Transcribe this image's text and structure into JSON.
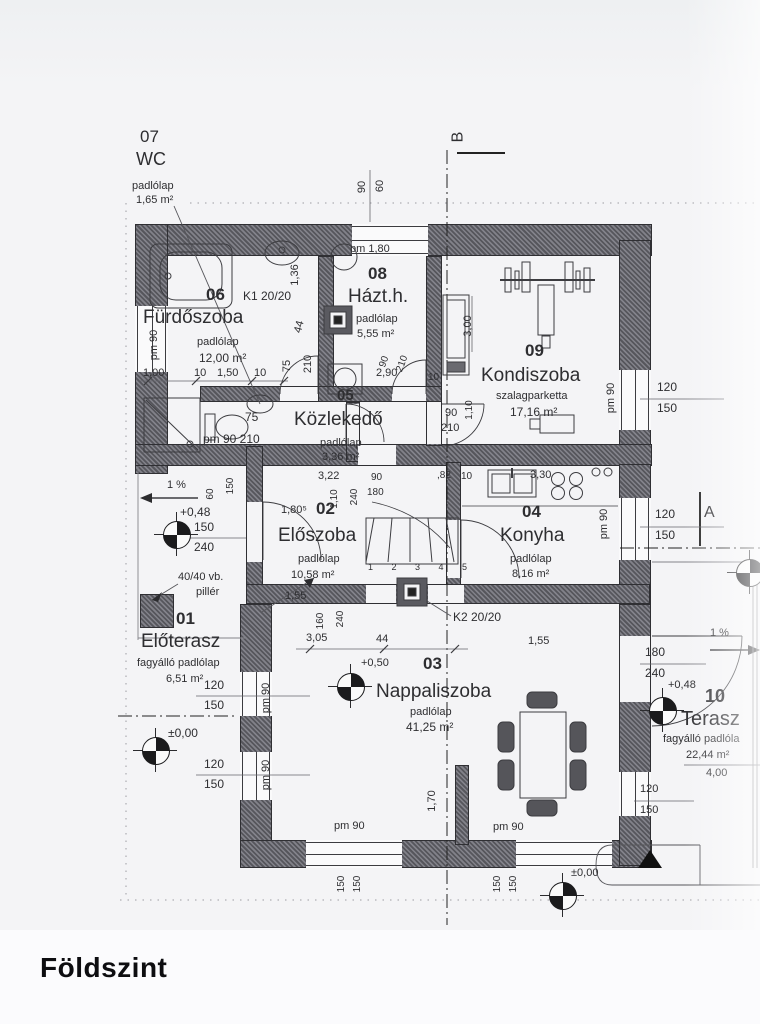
{
  "title": "Földszint",
  "colors": {
    "paper": "#f4f4f6",
    "ink": "#2e2e31",
    "wall_hatch": "#6a6a70"
  },
  "section_markers": {
    "a": "A",
    "b": "B"
  },
  "rooms": [
    {
      "number": "01",
      "name": "Előterasz",
      "surface": "fagyálló padlólap",
      "area": "6,51 m²"
    },
    {
      "number": "02",
      "name": "Előszoba",
      "surface": "padlólap",
      "area": "10,58 m²"
    },
    {
      "number": "03",
      "name": "Nappaliszoba",
      "surface": "padlólap",
      "area": "41,25 m²"
    },
    {
      "number": "04",
      "name": "Konyha",
      "surface": "padlólap",
      "area": "8,16 m²"
    },
    {
      "number": "05",
      "name": "Közlekedő",
      "surface": "padlólap",
      "area": "3,36 m²"
    },
    {
      "number": "06",
      "name": "Fürdőszoba",
      "surface": "padlólap",
      "area": "12,00 m²"
    },
    {
      "number": "07",
      "name": "WC",
      "surface": "padlólap",
      "area": "1,65 m²"
    },
    {
      "number": "08",
      "name": "Házt.h.",
      "surface": "padlólap",
      "area": "5,55 m²"
    },
    {
      "number": "09",
      "name": "Kondiszoba",
      "surface": "szalagparketta",
      "area": "17,16 m²"
    },
    {
      "number": "10",
      "name": "Terasz",
      "surface": "fagyálló padlóla",
      "area": "22,44 m²"
    }
  ],
  "labels": [
    {
      "n": "room07-number",
      "t": "07",
      "x": 140,
      "y": 128,
      "fs": 17
    },
    {
      "n": "room07-name",
      "t": "WC",
      "x": 136,
      "y": 150,
      "fs": 18
    },
    {
      "n": "room07-floor",
      "t": "padlólap",
      "x": 132,
      "y": 181,
      "fs": 11
    },
    {
      "n": "room07-area",
      "t": "1,65 m²",
      "x": 136,
      "y": 195,
      "fs": 11
    },
    {
      "n": "dim-top-90",
      "t": "90",
      "x": 363,
      "y": 187,
      "rot": -90
    },
    {
      "n": "dim-top-60",
      "t": "60",
      "x": 381,
      "y": 186,
      "rot": -90
    },
    {
      "n": "section-b-label",
      "t": "B",
      "x": 459,
      "y": 137,
      "fs": 16,
      "rot": -90
    },
    {
      "n": "room06-number",
      "t": "06",
      "x": 206,
      "y": 286,
      "fs": 17,
      "fw": 600
    },
    {
      "n": "dim-k1",
      "t": "K1 20/20",
      "x": 243,
      "y": 290,
      "fs": 12
    },
    {
      "n": "room06-name",
      "t": "Fürdőszoba",
      "x": 143,
      "y": 308,
      "fs": 19
    },
    {
      "n": "room06-floor",
      "t": "padlólap",
      "x": 197,
      "y": 337
    },
    {
      "n": "room06-area",
      "t": "12,00 m²",
      "x": 199,
      "y": 352,
      "fs": 12
    },
    {
      "n": "dim-1-00",
      "t": "1,00",
      "x": 143,
      "y": 368
    },
    {
      "n": "dim-10-a",
      "t": "10",
      "x": 194,
      "y": 368
    },
    {
      "n": "dim-1-50",
      "t": "1,50",
      "x": 217,
      "y": 368
    },
    {
      "n": "dim-10-b",
      "t": "10",
      "x": 254,
      "y": 368
    },
    {
      "n": "pm90-furdo",
      "t": "pm 90",
      "x": 155,
      "y": 345,
      "rot": -90
    },
    {
      "n": "dim-1-36",
      "t": "1,36",
      "x": 296,
      "y": 275,
      "rot": -90
    },
    {
      "n": "dim-44-k1",
      "t": "44",
      "x": 300,
      "y": 327,
      "rot": -75
    },
    {
      "n": "dim-75-f",
      "t": "75",
      "x": 288,
      "y": 366,
      "rot": -90
    },
    {
      "n": "dim-210-f",
      "t": "210",
      "x": 309,
      "y": 364,
      "rot": -90
    },
    {
      "n": "dim-75-wc",
      "t": "75",
      "x": 245,
      "y": 411,
      "fs": 12
    },
    {
      "n": "dim-pm90-210-wc",
      "t": "pm 90 210",
      "x": 203,
      "y": 433,
      "fs": 12
    },
    {
      "n": "dim-pm-1-80",
      "t": "pm 1,80",
      "x": 350,
      "y": 244
    },
    {
      "n": "room08-number",
      "t": "08",
      "x": 368,
      "y": 265,
      "fs": 17,
      "fw": 600
    },
    {
      "n": "room08-name",
      "t": "Házt.h.",
      "x": 348,
      "y": 287,
      "fs": 19
    },
    {
      "n": "room08-floor",
      "t": "padlólap",
      "x": 356,
      "y": 314
    },
    {
      "n": "room08-area",
      "t": "5,55 m²",
      "x": 357,
      "y": 329
    },
    {
      "n": "dim-2-90",
      "t": "2,90",
      "x": 376,
      "y": 368
    },
    {
      "n": "dim-90-h",
      "t": "90",
      "x": 385,
      "y": 362,
      "rot": -70,
      "fs": 10
    },
    {
      "n": "dim-210-h",
      "t": "210",
      "x": 403,
      "y": 364,
      "rot": -70,
      "fs": 10
    },
    {
      "n": "dim-10-h",
      "t": "10",
      "x": 428,
      "y": 373,
      "fs": 10
    },
    {
      "n": "room05-number",
      "t": "05",
      "x": 337,
      "y": 388,
      "fs": 15,
      "fw": 600
    },
    {
      "n": "dim-3-00",
      "t": "3,00",
      "x": 469,
      "y": 326,
      "rot": -90
    },
    {
      "n": "room09-number",
      "t": "09",
      "x": 525,
      "y": 342,
      "fs": 17,
      "fw": 600
    },
    {
      "n": "room09-name",
      "t": "Kondiszoba",
      "x": 481,
      "y": 366,
      "fs": 19
    },
    {
      "n": "room09-floor",
      "t": "szalagparketta",
      "x": 496,
      "y": 391
    },
    {
      "n": "room09-area",
      "t": "17,16 m²",
      "x": 510,
      "y": 406,
      "fs": 12
    },
    {
      "n": "pm90-kondi",
      "t": "pm 90",
      "x": 612,
      "y": 398,
      "rot": -90
    },
    {
      "n": "dim-120-kon",
      "t": "120",
      "x": 657,
      "y": 381,
      "fs": 12
    },
    {
      "n": "dim-150-kon",
      "t": "150",
      "x": 657,
      "y": 402,
      "fs": 12
    },
    {
      "n": "dim-1-10-kon",
      "t": "1,10",
      "x": 470,
      "y": 410,
      "rot": -90,
      "fs": 10
    },
    {
      "n": "room05-name",
      "t": "Közlekedő",
      "x": 294,
      "y": 410,
      "fs": 19
    },
    {
      "n": "room05-floor",
      "t": "padlólap",
      "x": 320,
      "y": 438
    },
    {
      "n": "room05-area",
      "t": "3,36 m²",
      "x": 322,
      "y": 452
    },
    {
      "n": "dim-90-koz",
      "t": "90",
      "x": 445,
      "y": 408
    },
    {
      "n": "dim-210-koz",
      "t": "210",
      "x": 441,
      "y": 423
    },
    {
      "n": "dim-3-22",
      "t": "3,22",
      "x": 318,
      "y": 471
    },
    {
      "n": "dim-90-p",
      "t": "90",
      "x": 371,
      "y": 473,
      "fs": 10
    },
    {
      "n": "dim-180-p",
      "t": "180",
      "x": 367,
      "y": 488,
      "fs": 10
    },
    {
      "n": "dim-240-p",
      "t": "240",
      "x": 355,
      "y": 497,
      "rot": -90,
      "fs": 10
    },
    {
      "n": "dim-1-10-p",
      "t": "1,10",
      "x": 335,
      "y": 499,
      "rot": -90,
      "fs": 10
    },
    {
      "n": "dim-82",
      "t": ",82",
      "x": 437,
      "y": 471,
      "fs": 10
    },
    {
      "n": "dim-10-p",
      "t": "10",
      "x": 461,
      "y": 472,
      "fs": 10
    },
    {
      "n": "dim-3-30",
      "t": "3,30",
      "x": 530,
      "y": 470
    },
    {
      "n": "dim-1-80-5",
      "t": "1,80⁵",
      "x": 281,
      "y": 505
    },
    {
      "n": "room02-number",
      "t": "02",
      "x": 316,
      "y": 500,
      "fs": 17,
      "fw": 600
    },
    {
      "n": "room02-name",
      "t": "Előszoba",
      "x": 278,
      "y": 526,
      "fs": 19
    },
    {
      "n": "room02-floor",
      "t": "padlólap",
      "x": 298,
      "y": 554
    },
    {
      "n": "room02-area",
      "t": "10,58 m²",
      "x": 291,
      "y": 570
    },
    {
      "n": "stair-numbers",
      "t": "1 2 3 4 5",
      "x": 368,
      "y": 563,
      "fs": 9,
      "ls": 8
    },
    {
      "n": "dim-1-55-e",
      "t": "1,55",
      "x": 285,
      "y": 591
    },
    {
      "n": "dim-160-e",
      "t": "160",
      "x": 321,
      "y": 621,
      "rot": -90,
      "fs": 10
    },
    {
      "n": "dim-240-e",
      "t": "240",
      "x": 341,
      "y": 619,
      "rot": -90,
      "fs": 10
    },
    {
      "n": "dim-3-05",
      "t": "3,05",
      "x": 306,
      "y": 633
    },
    {
      "n": "dim-44-e",
      "t": "44",
      "x": 376,
      "y": 634
    },
    {
      "n": "k2-label",
      "t": "K2 20/20",
      "x": 453,
      "y": 611,
      "fs": 12
    },
    {
      "n": "room04-number",
      "t": "04",
      "x": 522,
      "y": 503,
      "fs": 17,
      "fw": 600
    },
    {
      "n": "room04-name",
      "t": "Konyha",
      "x": 500,
      "y": 526,
      "fs": 19
    },
    {
      "n": "room04-floor",
      "t": "padlólap",
      "x": 510,
      "y": 554
    },
    {
      "n": "room04-area",
      "t": "8,16 m²",
      "x": 512,
      "y": 569
    },
    {
      "n": "pm90-konyha",
      "t": "pm 90",
      "x": 605,
      "y": 524,
      "rot": -90
    },
    {
      "n": "dim-120-kny",
      "t": "120",
      "x": 655,
      "y": 508,
      "fs": 12
    },
    {
      "n": "dim-150-kny",
      "t": "150",
      "x": 655,
      "y": 529,
      "fs": 12
    },
    {
      "n": "slope-left-label",
      "t": "1 %",
      "x": 167,
      "y": 480
    },
    {
      "n": "dim-60-l",
      "t": "60",
      "x": 211,
      "y": 494,
      "rot": -90,
      "fs": 10
    },
    {
      "n": "dim-150-l",
      "t": "150",
      "x": 231,
      "y": 486,
      "rot": -90,
      "fs": 10
    },
    {
      "n": "level-048-left-label",
      "t": "+0,48",
      "x": 180,
      "y": 506,
      "fs": 12
    },
    {
      "n": "dim-150-door",
      "t": "150",
      "x": 194,
      "y": 521,
      "fs": 12
    },
    {
      "n": "dim-240-door",
      "t": "240",
      "x": 194,
      "y": 541,
      "fs": 12
    },
    {
      "n": "pillar-note-1",
      "t": "40/40 vb.",
      "x": 178,
      "y": 572
    },
    {
      "n": "pillar-note-2",
      "t": "pillér",
      "x": 196,
      "y": 587
    },
    {
      "n": "room01-number",
      "t": "01",
      "x": 176,
      "y": 610,
      "fs": 17,
      "fw": 600
    },
    {
      "n": "room01-name",
      "t": "Előterasz",
      "x": 141,
      "y": 632,
      "fs": 19
    },
    {
      "n": "room01-floor",
      "t": "fagyálló padlólap",
      "x": 137,
      "y": 658
    },
    {
      "n": "room01-area",
      "t": "6,51 m²",
      "x": 166,
      "y": 674
    },
    {
      "n": "dim-120-ea",
      "t": "120",
      "x": 204,
      "y": 679,
      "fs": 12
    },
    {
      "n": "dim-150-ea",
      "t": "150",
      "x": 204,
      "y": 699,
      "fs": 12
    },
    {
      "n": "pm90-ea",
      "t": "pm 90",
      "x": 267,
      "y": 698,
      "rot": -90
    },
    {
      "n": "level-000-left-label",
      "t": "±0,00",
      "x": 168,
      "y": 727,
      "fs": 12
    },
    {
      "n": "dim-120-eb",
      "t": "120",
      "x": 204,
      "y": 758,
      "fs": 12
    },
    {
      "n": "dim-150-eb",
      "t": "150",
      "x": 204,
      "y": 778,
      "fs": 12
    },
    {
      "n": "pm90-eb",
      "t": "pm 90",
      "x": 267,
      "y": 775,
      "rot": -90
    },
    {
      "n": "level-050-label",
      "t": "+0,50",
      "x": 361,
      "y": 658
    },
    {
      "n": "room03-number",
      "t": "03",
      "x": 423,
      "y": 655,
      "fs": 17,
      "fw": 600
    },
    {
      "n": "room03-name",
      "t": "Nappaliszoba",
      "x": 376,
      "y": 682,
      "fs": 19
    },
    {
      "n": "room03-floor",
      "t": "padlólap",
      "x": 410,
      "y": 707
    },
    {
      "n": "room03-area",
      "t": "41,25 m²",
      "x": 406,
      "y": 721,
      "fs": 12
    },
    {
      "n": "dim-1-70",
      "t": "1,70",
      "x": 433,
      "y": 801,
      "rot": -90
    },
    {
      "n": "pm90-s1",
      "t": "pm 90",
      "x": 334,
      "y": 821
    },
    {
      "n": "pm90-s2",
      "t": "pm 90",
      "x": 493,
      "y": 822
    },
    {
      "n": "dim-150-s1a",
      "t": "150",
      "x": 342,
      "y": 884,
      "rot": -90,
      "fs": 10
    },
    {
      "n": "dim-150-s1b",
      "t": "150",
      "x": 358,
      "y": 884,
      "rot": -90,
      "fs": 10
    },
    {
      "n": "dim-150-s2a",
      "t": "150",
      "x": 498,
      "y": 884,
      "rot": -90,
      "fs": 10
    },
    {
      "n": "dim-150-s2b",
      "t": "150",
      "x": 514,
      "y": 884,
      "rot": -90,
      "fs": 10
    },
    {
      "n": "level-000-br-label",
      "t": "±0,00",
      "x": 571,
      "y": 868
    },
    {
      "n": "dim-1-55-t",
      "t": "1,55",
      "x": 528,
      "y": 636
    },
    {
      "n": "dim-180-t",
      "t": "180",
      "x": 645,
      "y": 646,
      "fs": 12
    },
    {
      "n": "dim-240-t",
      "t": "240",
      "x": 645,
      "y": 667,
      "fs": 12
    },
    {
      "n": "slope-right-label",
      "t": "1 %",
      "x": 710,
      "y": 628
    },
    {
      "n": "level-048-t-label",
      "t": "+0,48",
      "x": 668,
      "y": 680
    },
    {
      "n": "room10-number",
      "t": "10",
      "x": 705,
      "y": 687,
      "fs": 18,
      "fw": 600
    },
    {
      "n": "room10-name",
      "t": "Terasz",
      "x": 681,
      "y": 709,
      "fs": 20
    },
    {
      "n": "room10-floor",
      "t": "fagyálló padlóla",
      "x": 663,
      "y": 734
    },
    {
      "n": "room10-area",
      "t": "22,44 m²",
      "x": 686,
      "y": 750
    },
    {
      "n": "dim-4-00",
      "t": "4,00",
      "x": 706,
      "y": 768
    },
    {
      "n": "dim-120-tr",
      "t": "120",
      "x": 640,
      "y": 784
    },
    {
      "n": "dim-150-tr",
      "t": "150",
      "x": 640,
      "y": 805
    },
    {
      "n": "section-a-label",
      "t": "A",
      "x": 704,
      "y": 505,
      "fs": 16
    }
  ]
}
